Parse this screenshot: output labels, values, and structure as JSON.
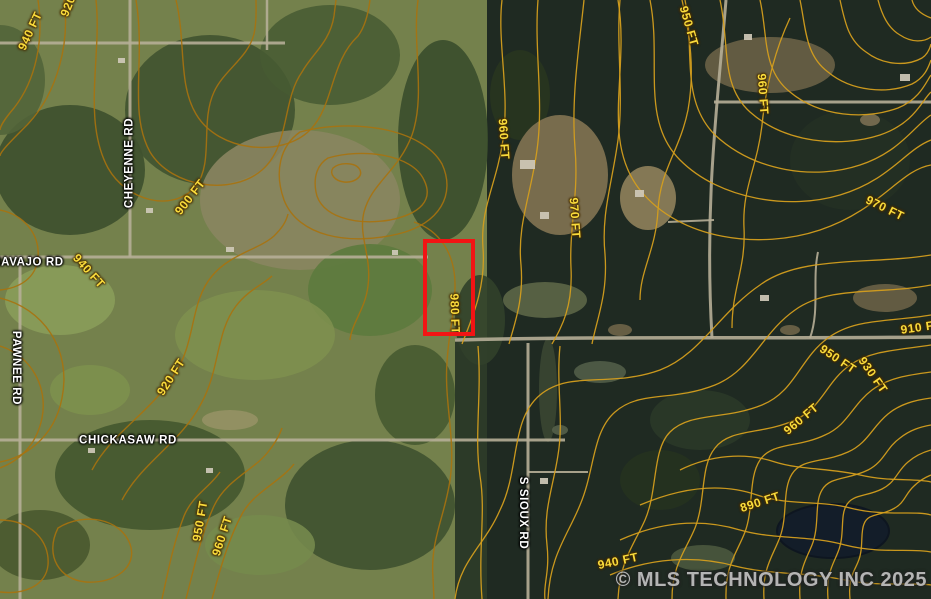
{
  "map": {
    "type": "satellite-with-topo-contours",
    "parcel_outline_color": "#f21414",
    "contour_label_color": "#fadc3c",
    "road_label_color": "#ffffff"
  },
  "road_labels": [
    {
      "text": "CHEYENNE RD"
    },
    {
      "text": "NAVAJO RD"
    },
    {
      "text": "PAWNEE RD"
    },
    {
      "text": "CHICKASAW RD"
    },
    {
      "text": "S SIOUX RD"
    }
  ],
  "contour_labels": [
    {
      "text": "940 FT",
      "elevation_ft": 940
    },
    {
      "text": "920",
      "elevation_ft": 920
    },
    {
      "text": "900 FT",
      "elevation_ft": 900
    },
    {
      "text": "940 FT",
      "elevation_ft": 940
    },
    {
      "text": "920 FT",
      "elevation_ft": 920
    },
    {
      "text": "950 FT",
      "elevation_ft": 950
    },
    {
      "text": "960 FT",
      "elevation_ft": 960
    },
    {
      "text": "960 FT",
      "elevation_ft": 960
    },
    {
      "text": "970 FT",
      "elevation_ft": 970
    },
    {
      "text": "980 FT",
      "elevation_ft": 980
    },
    {
      "text": "950 FT",
      "elevation_ft": 950
    },
    {
      "text": "960 FT",
      "elevation_ft": 960
    },
    {
      "text": "970 FT",
      "elevation_ft": 970
    },
    {
      "text": "910 FT",
      "elevation_ft": 910
    },
    {
      "text": "950 FT",
      "elevation_ft": 950
    },
    {
      "text": "930 FT",
      "elevation_ft": 930
    },
    {
      "text": "960 FT",
      "elevation_ft": 960
    },
    {
      "text": "890 FT",
      "elevation_ft": 890
    },
    {
      "text": "940 FT",
      "elevation_ft": 940
    }
  ],
  "watermark": {
    "text": "© MLS TECHNOLOGY INC 2025"
  }
}
